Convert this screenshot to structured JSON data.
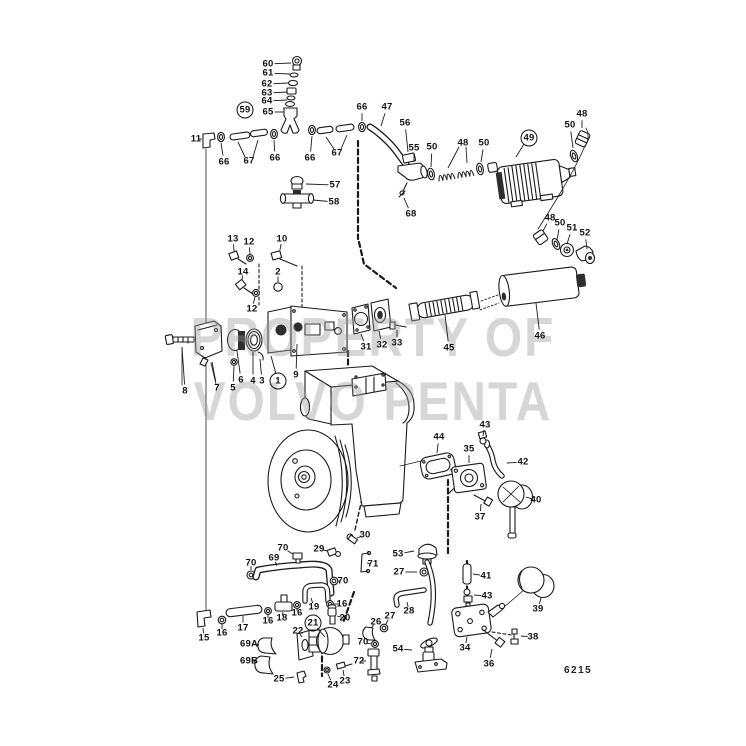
{
  "document": {
    "watermark_line1": "PROPERTY OF",
    "watermark_line2": "VOLVO PENTA",
    "figure_code": "6215",
    "ink_color": "#1b1b1b",
    "watermark_color": "#9a9a9a"
  },
  "callouts": [
    {
      "t": "60",
      "x": 268,
      "y": 64,
      "lx": 291,
      "ly": 63
    },
    {
      "t": "61",
      "x": 268,
      "y": 73,
      "lx": 290,
      "ly": 74
    },
    {
      "t": "62",
      "x": 267,
      "y": 84,
      "lx": 289,
      "ly": 83
    },
    {
      "t": "63",
      "x": 267,
      "y": 93,
      "lx": 287,
      "ly": 92
    },
    {
      "t": "64",
      "x": 267,
      "y": 101,
      "lx": 287,
      "ly": 100
    },
    {
      "t": "65",
      "x": 268,
      "y": 112,
      "lx": 284,
      "ly": 112
    },
    {
      "t": "59",
      "x": 245,
      "y": 110,
      "circled": true
    },
    {
      "t": "11",
      "x": 196,
      "y": 139,
      "lx": 202,
      "ly": 139
    },
    {
      "t": "66",
      "x": 224,
      "y": 162,
      "lx": 221,
      "ly": 143
    },
    {
      "t": "67",
      "x": 249,
      "y": 161
    },
    {
      "t": "66",
      "x": 275,
      "y": 158,
      "lx": 274,
      "ly": 140
    },
    {
      "t": "66",
      "x": 310,
      "y": 158,
      "lx": 312,
      "ly": 136
    },
    {
      "t": "67",
      "x": 337,
      "y": 153
    },
    {
      "t": "66",
      "x": 362,
      "y": 107,
      "lx": 362,
      "ly": 121
    },
    {
      "t": "47",
      "x": 387,
      "y": 107,
      "lx": 381,
      "ly": 126
    },
    {
      "t": "56",
      "x": 405,
      "y": 123,
      "lx": 408,
      "ly": 152
    },
    {
      "t": "55",
      "x": 414,
      "y": 148,
      "lx": 414,
      "ly": 162
    },
    {
      "t": "50",
      "x": 432,
      "y": 147,
      "lx": 431,
      "ly": 167
    },
    {
      "t": "48",
      "x": 463,
      "y": 143
    },
    {
      "t": "50",
      "x": 484,
      "y": 143,
      "lx": 481,
      "ly": 162
    },
    {
      "t": "68",
      "x": 411,
      "y": 214,
      "lx": 404,
      "ly": 198
    },
    {
      "t": "57",
      "x": 335,
      "y": 185,
      "lx": 306,
      "ly": 184
    },
    {
      "t": "58",
      "x": 334,
      "y": 202,
      "lx": 313,
      "ly": 200
    },
    {
      "t": "49",
      "x": 529,
      "y": 138,
      "circled": true
    },
    {
      "t": "50",
      "x": 570,
      "y": 125,
      "lx": 573,
      "ly": 148
    },
    {
      "t": "48",
      "x": 582,
      "y": 114,
      "lx": 582,
      "ly": 128
    },
    {
      "t": "48",
      "x": 550,
      "y": 218,
      "lx": 543,
      "ly": 231
    },
    {
      "t": "50",
      "x": 560,
      "y": 223,
      "lx": 557,
      "ly": 240
    },
    {
      "t": "51",
      "x": 572,
      "y": 228,
      "lx": 567,
      "ly": 244
    },
    {
      "t": "52",
      "x": 585,
      "y": 233,
      "lx": 587,
      "ly": 249
    },
    {
      "t": "13",
      "x": 233,
      "y": 239,
      "lx": 234,
      "ly": 251
    },
    {
      "t": "12",
      "x": 249,
      "y": 242,
      "lx": 250,
      "ly": 254
    },
    {
      "t": "10",
      "x": 282,
      "y": 239,
      "lx": 280,
      "ly": 250
    },
    {
      "t": "14",
      "x": 243,
      "y": 272,
      "lx": 242,
      "ly": 280
    },
    {
      "t": "2",
      "x": 278,
      "y": 272,
      "lx": 278,
      "ly": 282
    },
    {
      "t": "12",
      "x": 252,
      "y": 309,
      "lx": 255,
      "ly": 297
    },
    {
      "t": "8",
      "x": 185,
      "y": 391,
      "lx": 182,
      "ly": 347
    },
    {
      "t": "7",
      "x": 217,
      "y": 388,
      "lx": 212,
      "ly": 362
    },
    {
      "t": "5",
      "x": 233,
      "y": 388,
      "lx": 234,
      "ly": 366
    },
    {
      "t": "6",
      "x": 241,
      "y": 380,
      "lx": 237,
      "ly": 351
    },
    {
      "t": "4",
      "x": 253,
      "y": 381,
      "lx": 253,
      "ly": 352
    },
    {
      "t": "3",
      "x": 262,
      "y": 381,
      "lx": 260,
      "ly": 359
    },
    {
      "t": "1",
      "x": 278,
      "y": 381,
      "circled": true
    },
    {
      "t": "9",
      "x": 296,
      "y": 375,
      "lx": 297,
      "ly": 344
    },
    {
      "t": "31",
      "x": 366,
      "y": 347,
      "lx": 361,
      "ly": 334
    },
    {
      "t": "32",
      "x": 382,
      "y": 345,
      "lx": 379,
      "ly": 331
    },
    {
      "t": "33",
      "x": 397,
      "y": 343,
      "lx": 397,
      "ly": 330
    },
    {
      "t": "45",
      "x": 449,
      "y": 348,
      "lx": 445,
      "ly": 315
    },
    {
      "t": "46",
      "x": 540,
      "y": 336,
      "lx": 536,
      "ly": 303
    },
    {
      "t": "44",
      "x": 439,
      "y": 437,
      "lx": 437,
      "ly": 453
    },
    {
      "t": "43",
      "x": 485,
      "y": 425,
      "lx": 483,
      "ly": 436
    },
    {
      "t": "35",
      "x": 469,
      "y": 449,
      "lx": 469,
      "ly": 463
    },
    {
      "t": "42",
      "x": 523,
      "y": 462,
      "lx": 507,
      "ly": 463
    },
    {
      "t": "40",
      "x": 536,
      "y": 500,
      "lx": 526,
      "ly": 497
    },
    {
      "t": "37",
      "x": 480,
      "y": 517,
      "lx": 481,
      "ly": 504
    },
    {
      "t": "30",
      "x": 365,
      "y": 535,
      "lx": 357,
      "ly": 538
    },
    {
      "t": "29",
      "x": 319,
      "y": 549,
      "lx": 328,
      "ly": 551
    },
    {
      "t": "71",
      "x": 373,
      "y": 564,
      "lx": 367,
      "ly": 563
    },
    {
      "t": "53",
      "x": 398,
      "y": 554,
      "lx": 414,
      "ly": 551
    },
    {
      "t": "27",
      "x": 399,
      "y": 572,
      "lx": 417,
      "ly": 572
    },
    {
      "t": "70",
      "x": 283,
      "y": 548,
      "lx": 293,
      "ly": 554
    },
    {
      "t": "69",
      "x": 274,
      "y": 558,
      "lx": 277,
      "ly": 566
    },
    {
      "t": "70",
      "x": 251,
      "y": 563,
      "lx": 251,
      "ly": 570
    },
    {
      "t": "70",
      "x": 343,
      "y": 581,
      "lx": 338,
      "ly": 581
    },
    {
      "t": "19",
      "x": 314,
      "y": 607,
      "lx": 311,
      "ly": 598
    },
    {
      "t": "16",
      "x": 342,
      "y": 604,
      "lx": 334,
      "ly": 604
    },
    {
      "t": "20",
      "x": 345,
      "y": 618,
      "lx": 337,
      "ly": 616
    },
    {
      "t": "16",
      "x": 297,
      "y": 613,
      "lx": 297,
      "ly": 608
    },
    {
      "t": "18",
      "x": 282,
      "y": 618,
      "lx": 283,
      "ly": 612
    },
    {
      "t": "16",
      "x": 268,
      "y": 621,
      "lx": 268,
      "ly": 615
    },
    {
      "t": "17",
      "x": 243,
      "y": 628,
      "lx": 243,
      "ly": 616
    },
    {
      "t": "16",
      "x": 222,
      "y": 633,
      "lx": 222,
      "ly": 624
    },
    {
      "t": "15",
      "x": 204,
      "y": 638,
      "lx": 203,
      "ly": 628
    },
    {
      "t": "69A",
      "x": 249,
      "y": 644,
      "lx": 259,
      "ly": 645
    },
    {
      "t": "69B",
      "x": 249,
      "y": 661,
      "lx": 257,
      "ly": 661
    },
    {
      "t": "22",
      "x": 298,
      "y": 631,
      "lx": 302,
      "ly": 637
    },
    {
      "t": "21",
      "x": 313,
      "y": 623,
      "circled": true
    },
    {
      "t": "25",
      "x": 279,
      "y": 679,
      "lx": 294,
      "ly": 677
    },
    {
      "t": "24",
      "x": 333,
      "y": 685,
      "lx": 328,
      "ly": 674
    },
    {
      "t": "23",
      "x": 345,
      "y": 681,
      "lx": 343,
      "ly": 670
    },
    {
      "t": "26",
      "x": 376,
      "y": 622,
      "lx": 371,
      "ly": 628
    },
    {
      "t": "27",
      "x": 390,
      "y": 616,
      "lx": 386,
      "ly": 624
    },
    {
      "t": "28",
      "x": 409,
      "y": 611,
      "lx": 407,
      "ly": 602
    },
    {
      "t": "72",
      "x": 359,
      "y": 661,
      "lx": 366,
      "ly": 661
    },
    {
      "t": "70",
      "x": 363,
      "y": 642,
      "lx": 371,
      "ly": 644
    },
    {
      "t": "54",
      "x": 398,
      "y": 649,
      "lx": 412,
      "ly": 650
    },
    {
      "t": "41",
      "x": 486,
      "y": 576,
      "lx": 473,
      "ly": 574
    },
    {
      "t": "43",
      "x": 487,
      "y": 596,
      "lx": 474,
      "ly": 595
    },
    {
      "t": "34",
      "x": 465,
      "y": 648,
      "lx": 467,
      "ly": 637
    },
    {
      "t": "36",
      "x": 489,
      "y": 664,
      "lx": 492,
      "ly": 649
    },
    {
      "t": "38",
      "x": 533,
      "y": 637,
      "lx": 521,
      "ly": 636
    },
    {
      "t": "39",
      "x": 538,
      "y": 609,
      "lx": 541,
      "ly": 598
    }
  ],
  "extra_leader_lines": [
    [
      245,
      157,
      238,
      142
    ],
    [
      253,
      157,
      258,
      140
    ],
    [
      334,
      149,
      326,
      137
    ],
    [
      341,
      149,
      347,
      135
    ],
    [
      459,
      147,
      448,
      168
    ],
    [
      466,
      147,
      467,
      163
    ],
    [
      524,
      144,
      516,
      157
    ],
    [
      276,
      374,
      271,
      356
    ],
    [
      317,
      628,
      325,
      637
    ]
  ]
}
